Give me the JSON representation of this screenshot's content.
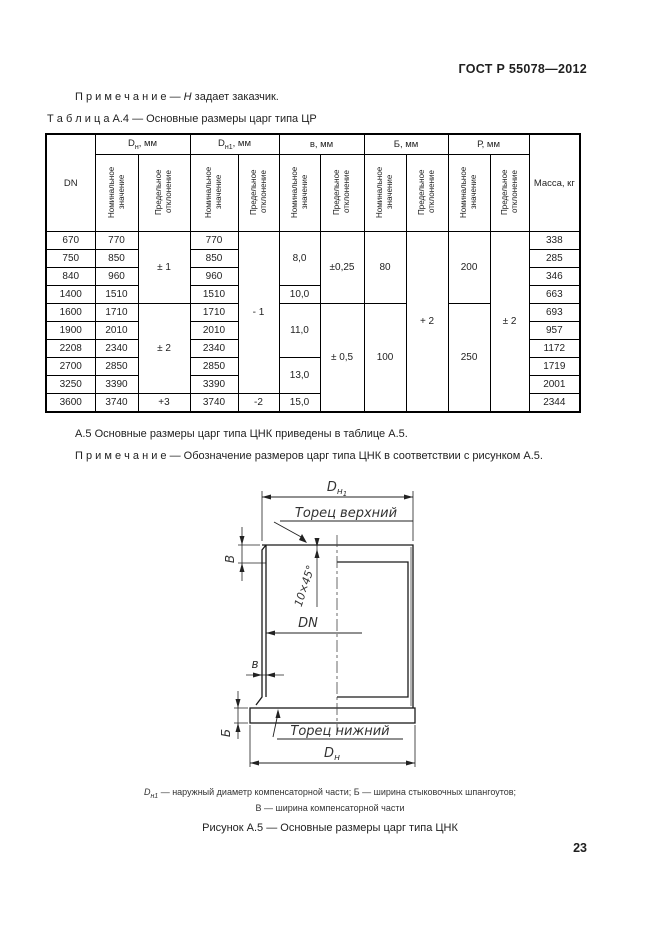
{
  "header": {
    "doc_code": "ГОСТ Р 55078—2012"
  },
  "page_number": "23",
  "note1": {
    "label": "П р и м е ч а н и е",
    "dash": " — ",
    "var": "Н",
    "rest": " задает заказчик."
  },
  "table_caption": {
    "label": "Т а б л и ц а  А.4",
    "rest": " — Основные размеры царг типа ЦР"
  },
  "table": {
    "col_dn": "DN",
    "col_mass": "Масса, кг",
    "col_widths": [
      49,
      43,
      52,
      48,
      41,
      41,
      44,
      42,
      42,
      42,
      39,
      51
    ],
    "groups": [
      {
        "base": "D",
        "sub": "н",
        "unit": ", мм"
      },
      {
        "base": "D",
        "sub": "н1",
        "unit": ", мм"
      },
      {
        "base": "в",
        "sub": "",
        "unit": ", мм"
      },
      {
        "base": "Б",
        "sub": "",
        "unit": ", мм"
      },
      {
        "base": "Р",
        "sub": "",
        "unit": ", мм"
      }
    ],
    "subheaders": {
      "nominal": "Номинальное значение",
      "deviation": "Предельное отклонение"
    },
    "rows": [
      [
        "670",
        "770",
        {
          "v": "± 1",
          "rs": 4
        },
        "770",
        {
          "v": "- 1",
          "rs": 9
        },
        {
          "v": "8,0",
          "rs": 3
        },
        {
          "v": "±0,25",
          "rs": 4
        },
        {
          "v": "80",
          "rs": 4
        },
        {
          "v": "+ 2",
          "rs": 10
        },
        {
          "v": "200",
          "rs": 4
        },
        {
          "v": "± 2",
          "rs": 10
        },
        "338"
      ],
      [
        "750",
        "850",
        "850",
        "285"
      ],
      [
        "840",
        "960",
        "960",
        "346"
      ],
      [
        "1400",
        "1510",
        "1510",
        {
          "v": "10,0"
        },
        "663"
      ],
      [
        "1600",
        "1710",
        {
          "v": "± 2",
          "rs": 5
        },
        "1710",
        {
          "v": "11,0",
          "rs": 3
        },
        {
          "v": "± 0,5",
          "rs": 6
        },
        {
          "v": "100",
          "rs": 6
        },
        {
          "v": "250",
          "rs": 6
        },
        "693"
      ],
      [
        "1900",
        "2010",
        "2010",
        "957"
      ],
      [
        "2208",
        "2340",
        "2340",
        "1172"
      ],
      [
        "2700",
        "2850",
        "2850",
        {
          "v": "13,0",
          "rs": 2
        },
        "1719"
      ],
      [
        "3250",
        "3390",
        "3390",
        "2001"
      ],
      [
        "3600",
        "3740",
        "+3",
        "3740",
        "-2",
        "15,0",
        "2344"
      ]
    ]
  },
  "para_a5": "А.5 Основные размеры царг типа ЦНК приведены в таблице А.5.",
  "note2": {
    "label": "П р и м е ч а н и е",
    "rest": " — Обозначение размеров царг типа ЦНК в соответствии с рисунком А.5."
  },
  "figure": {
    "dn1_base": "D",
    "dn1_sub": "н",
    "dn1_subsub": "1",
    "top_face": "Торец верхний",
    "bottom_face": "Торец нижний",
    "chamfer": "10×45°",
    "dn_label": "DN",
    "width_top": "В",
    "width_bottom": "Б",
    "wall": "в",
    "dn_base": "D",
    "dn_sub": "н"
  },
  "footnote": {
    "l1_var": "D",
    "l1_sub": "н1",
    "l1_rest": " — наружный диаметр компенсаторной части; Б — ширина стыковочных шпангоутов;",
    "l2": "В — ширина компенсаторной части"
  },
  "figure_caption": "Рисунок А.5 — Основные размеры царг типа ЦНК"
}
